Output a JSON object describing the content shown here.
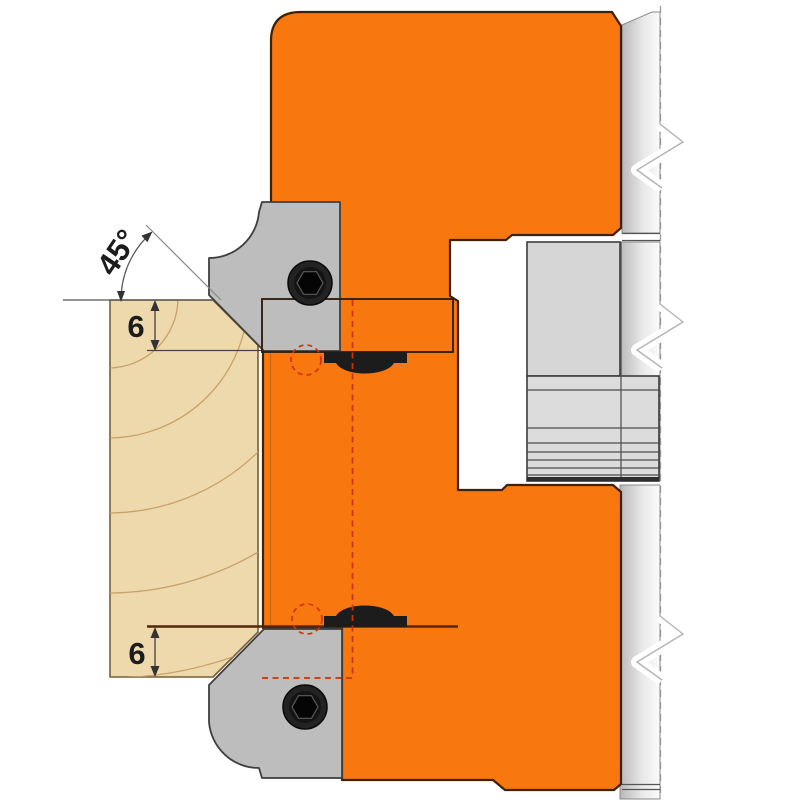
{
  "diagram": {
    "type": "technical-drawing",
    "subject": "Cutter head cross-section with reversible knives machining a 45-degree chamfer profile on a wood workpiece",
    "labels": {
      "chamfer_angle": "45°",
      "top_depth": "6",
      "bottom_depth": "6"
    },
    "colors": {
      "body_orange": "#f8780f",
      "body_outline": "#3d2206",
      "clamp_gray": "#bdbdbd",
      "clamp_outline": "#3f3f3f",
      "hub_gray": "#d6d6d6",
      "hub_outline": "#3c3c3c",
      "wood_fill": "#eed9ad",
      "wood_grain": "#c49b63",
      "wood_outline": "#7a5c35",
      "insert_black": "#1c1c1c",
      "hidden_red": "#cc3300",
      "cut_line_brown": "#54260a",
      "dimension_black": "#1c1c1c",
      "spacer_band_dark": "#2d2d2d"
    }
  }
}
